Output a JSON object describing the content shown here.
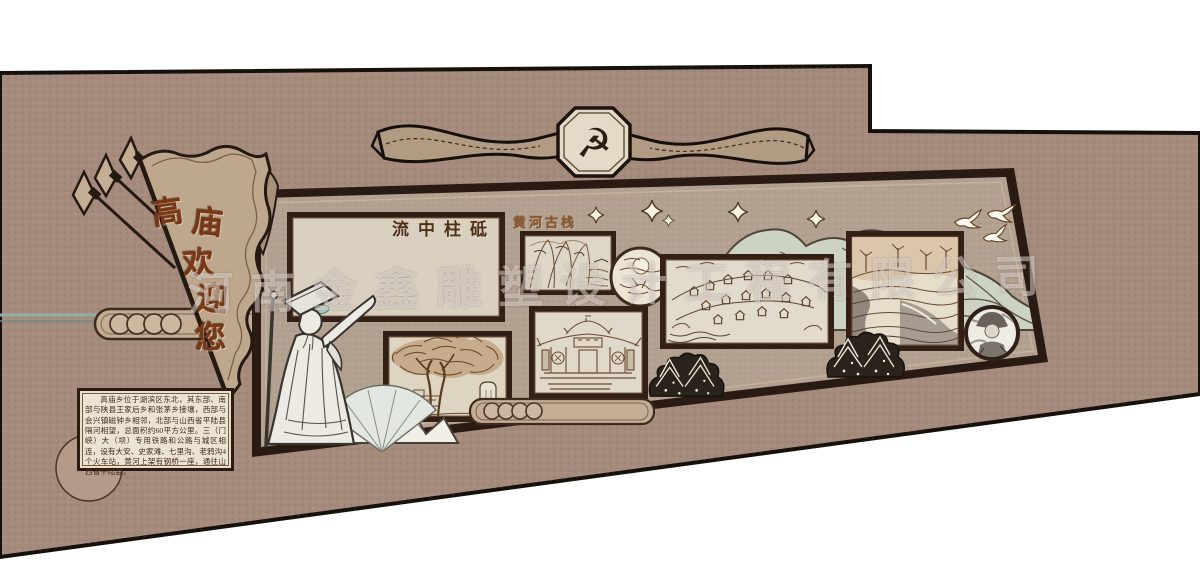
{
  "scene": {
    "description_label": "cultural-wall-design",
    "wall_color": "#a58b7c",
    "mural_face_color": "#b2a191",
    "accent_dark": "#2b1a10"
  },
  "banner": {
    "emblem_icon": "☭"
  },
  "pennant": {
    "text": "高庙欢迎您",
    "chars": [
      "高",
      "庙",
      "欢",
      "迎",
      "您"
    ],
    "char_color": "#7a3714"
  },
  "watermark": {
    "text": "河南金鑫雕塑设计工程有限公司",
    "color": "#ffffff"
  },
  "panels": {
    "dam": {
      "label": "流中柱砥"
    },
    "plank_road": {
      "label": "黄河古栈"
    }
  },
  "intro_box": {
    "text": "高庙乡位于湖滨区东北，其东部、南部与陕县王家后乡和张茅乡接壤，西部与会兴镇磁钟乡相邻，北部与山西省平陆县隔河相望，总面积约60平方公里。三（门峡）大（坝）专用铁路和公路与城区相连，设有大安、史家滩、七里沟、老鸦沟4个火车站，黄河上架有钢桥一座，通往山西省平陆县。"
  }
}
